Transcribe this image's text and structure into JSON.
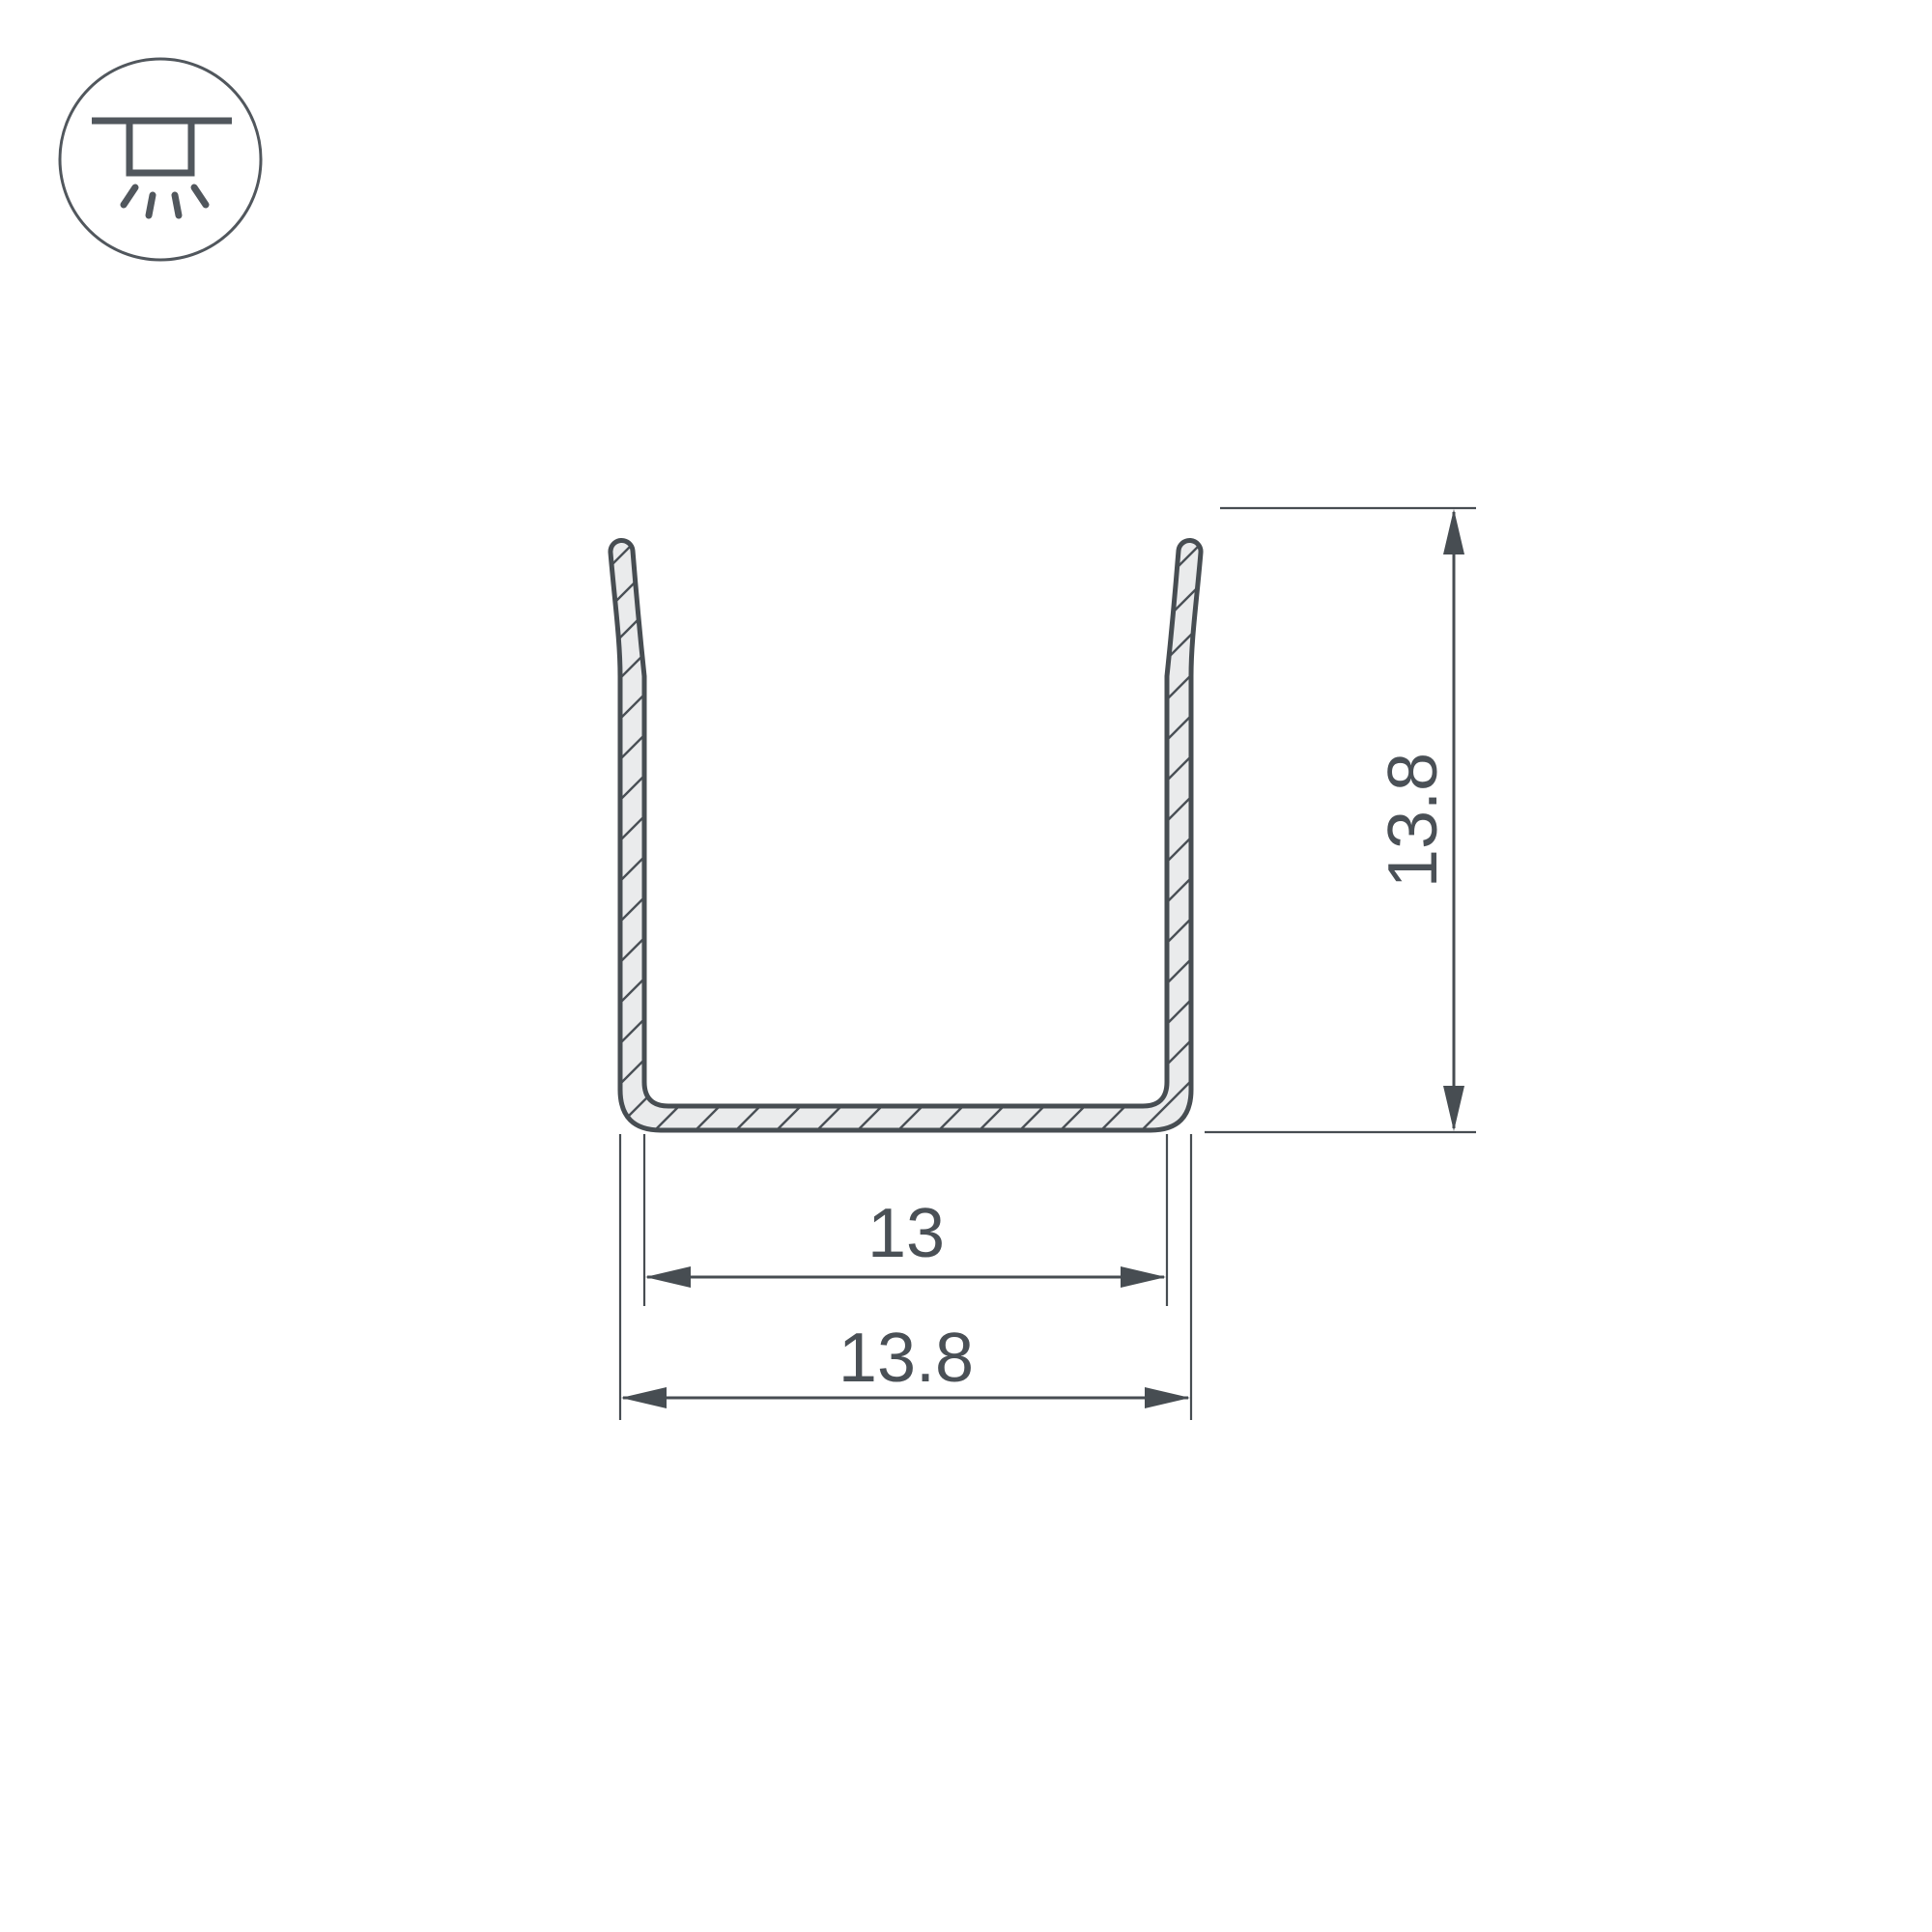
{
  "drawing": {
    "title": "U-channel profile cross-section drawing",
    "dimensions": {
      "inner_width": "13",
      "outer_width": "13.8",
      "height": "13.8"
    }
  },
  "icon": {
    "meaning": "surface-mounted-luminaire"
  },
  "colors": {
    "line": "#474d52",
    "text": "#4a5056",
    "profile_fill": "#eaebec",
    "icon_stroke": "#51575d",
    "background": "#ffffff"
  }
}
